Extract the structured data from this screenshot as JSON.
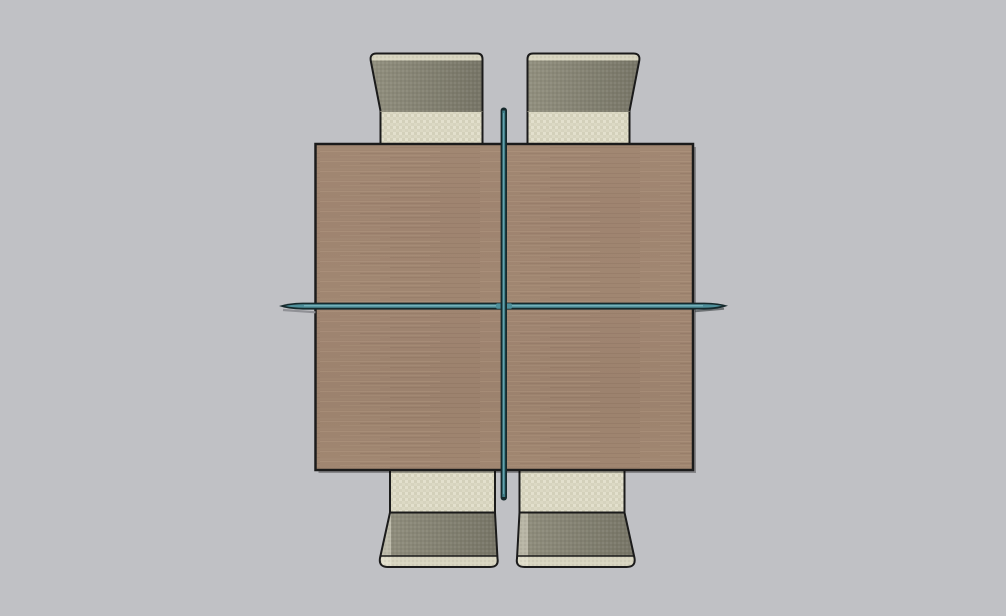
{
  "viewport": {
    "description": "3D modeling viewport, top-down orthographic view of a dining set",
    "width_px": 1006,
    "height_px": 616
  },
  "colors": {
    "background": "#C0C1C5",
    "outline": "#1B1B1B",
    "wood_base": "#9E846F",
    "wood_light": "#B59B84",
    "wood_dark": "#866D5B",
    "wood_mauve": "#A3837A",
    "cushion_base": "#DCD9C4",
    "cushion_dark": "#CBC8B2",
    "cushion_light": "#EAE7D6",
    "backrest_light": "#92907F",
    "backrest_dark": "#767466",
    "backrest_strip": "#D8D5C0",
    "glass_edge": "#15292C",
    "glass_teal": "#4E8F9A",
    "glass_light": "#7FB9C2",
    "pole_teal": "#3E7D87",
    "shadow": "#909196",
    "table_shadow": "rgba(0,0,0,0.30)",
    "tip_shadow": "rgba(40,48,50,0.55)"
  },
  "objects": {
    "table": {
      "label": "square wood table top"
    },
    "glass_shelf": {
      "label": "glass cross shelf extending past table edges"
    },
    "pole": {
      "label": "center support pole"
    },
    "chair_top_left": {
      "label": "chair, top left"
    },
    "chair_top_right": {
      "label": "chair, top right"
    },
    "chair_bottom_left": {
      "label": "chair, bottom left"
    },
    "chair_bottom_right": {
      "label": "chair, bottom right"
    }
  }
}
